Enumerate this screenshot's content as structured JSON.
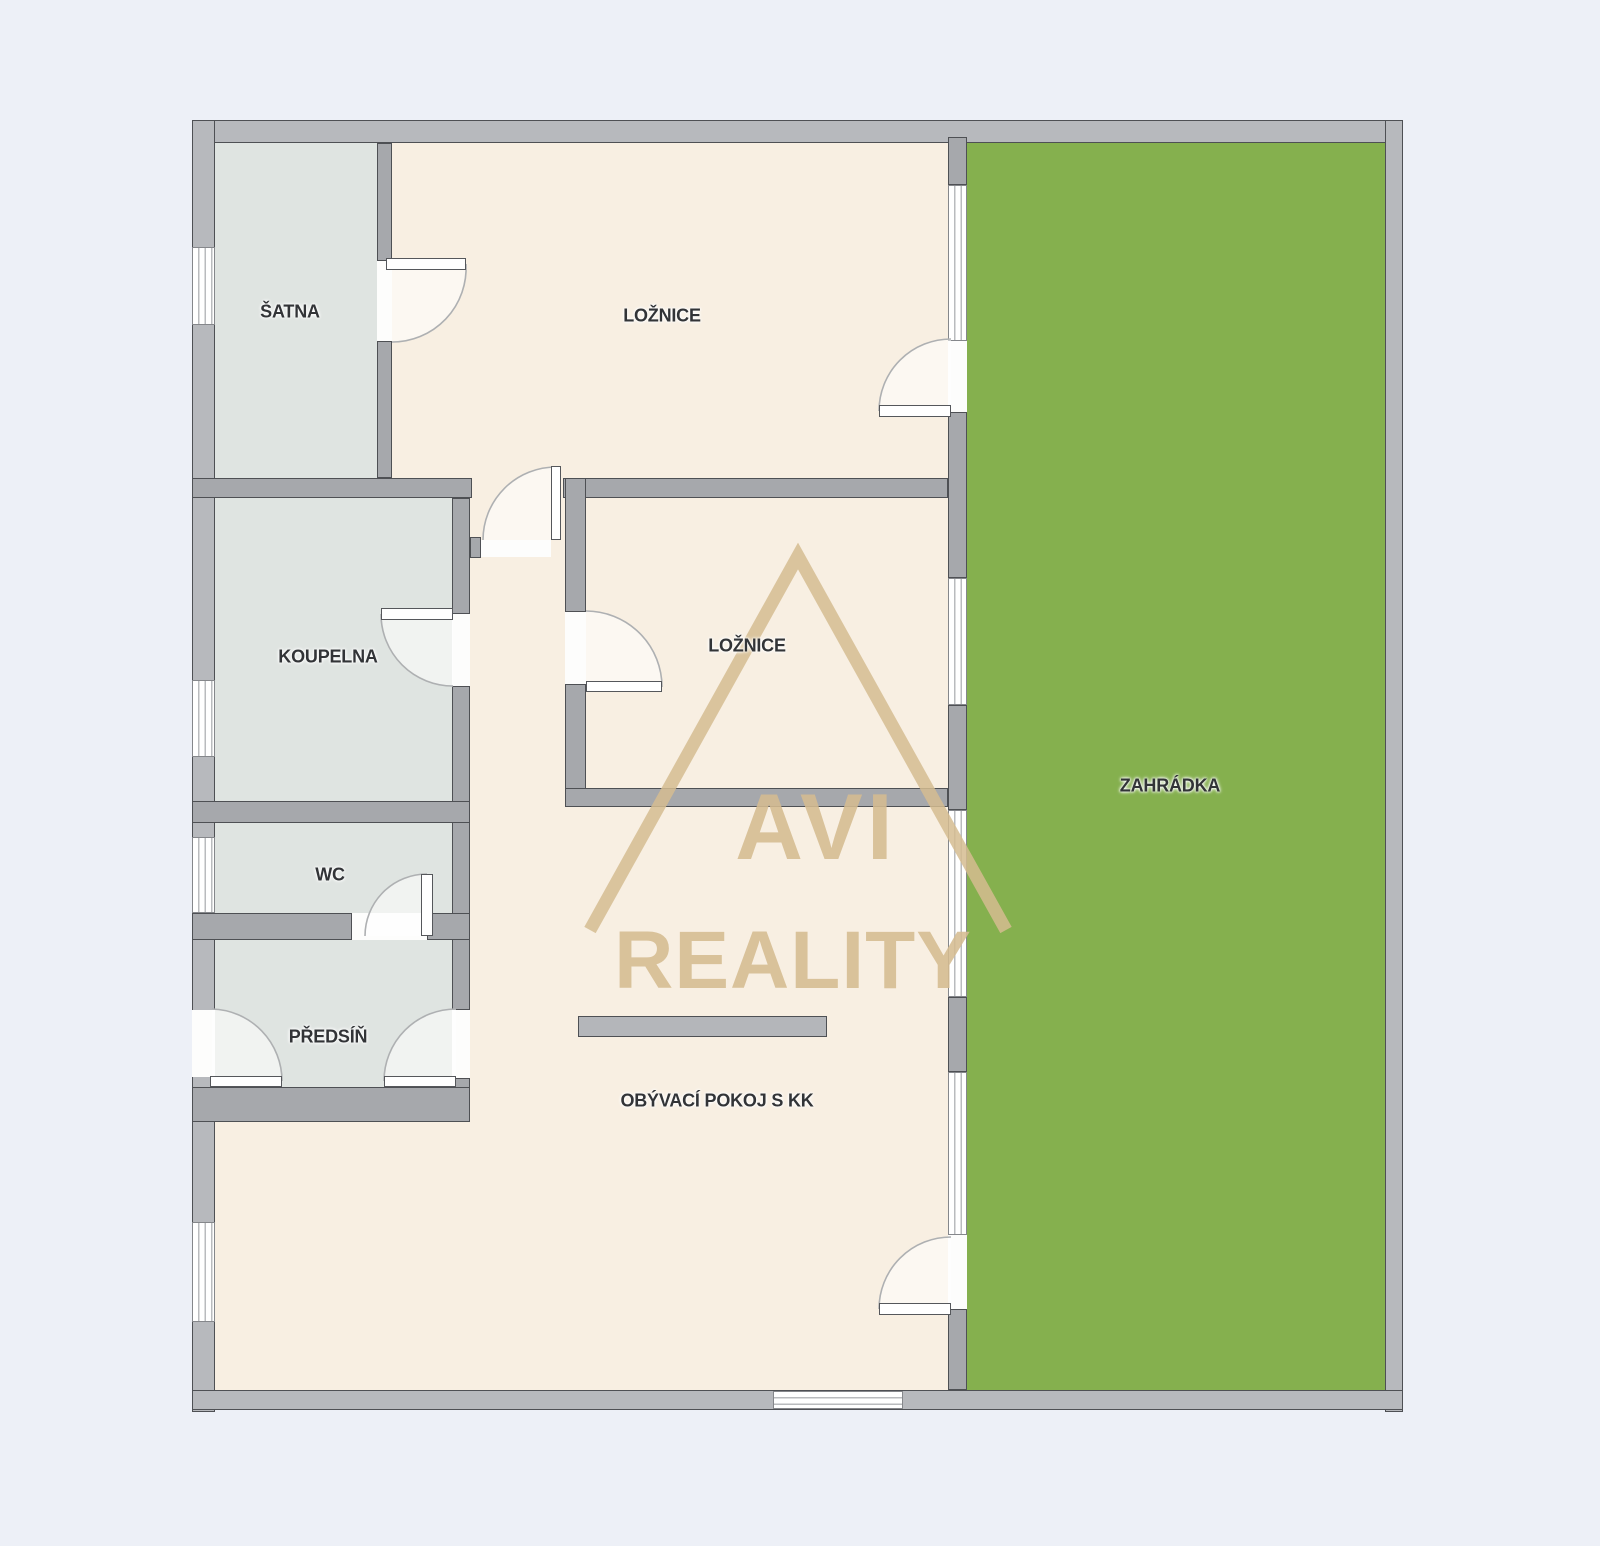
{
  "plan": {
    "type": "apartment-floor-plan",
    "rooms": {
      "satna": {
        "label": "ŠATNA"
      },
      "loznice_top": {
        "label": "LOŽNICE"
      },
      "koupelna": {
        "label": "KOUPELNA"
      },
      "wc": {
        "label": "WC"
      },
      "predsin": {
        "label": "PŘEDSÍŇ"
      },
      "loznice_mid": {
        "label": "LOŽNICE"
      },
      "obyvaci": {
        "label": "OBÝVACÍ POKOJ S KK"
      },
      "zahradka": {
        "label": "ZAHRÁDKA"
      }
    }
  },
  "watermark": {
    "line1": "AVI",
    "line2": "REALITY"
  },
  "colors": {
    "background": "#edf0f7",
    "wall_ext": "#b7b9bd",
    "wall_int": "#a6a8ac",
    "wall_border": "#4e5054",
    "floor_main": "#f8efe2",
    "floor_service": "#dfe4e1",
    "garden": "#85b04e",
    "window_frame": "#85878b",
    "window_line": "#b9bbbe",
    "opening": "#fdfdfc",
    "leaf_border": "#55575b",
    "counter": "#b4b6ba",
    "swing_line": "#aeb0b2",
    "watermark": "#d5bc91",
    "label_color": "#323437"
  }
}
